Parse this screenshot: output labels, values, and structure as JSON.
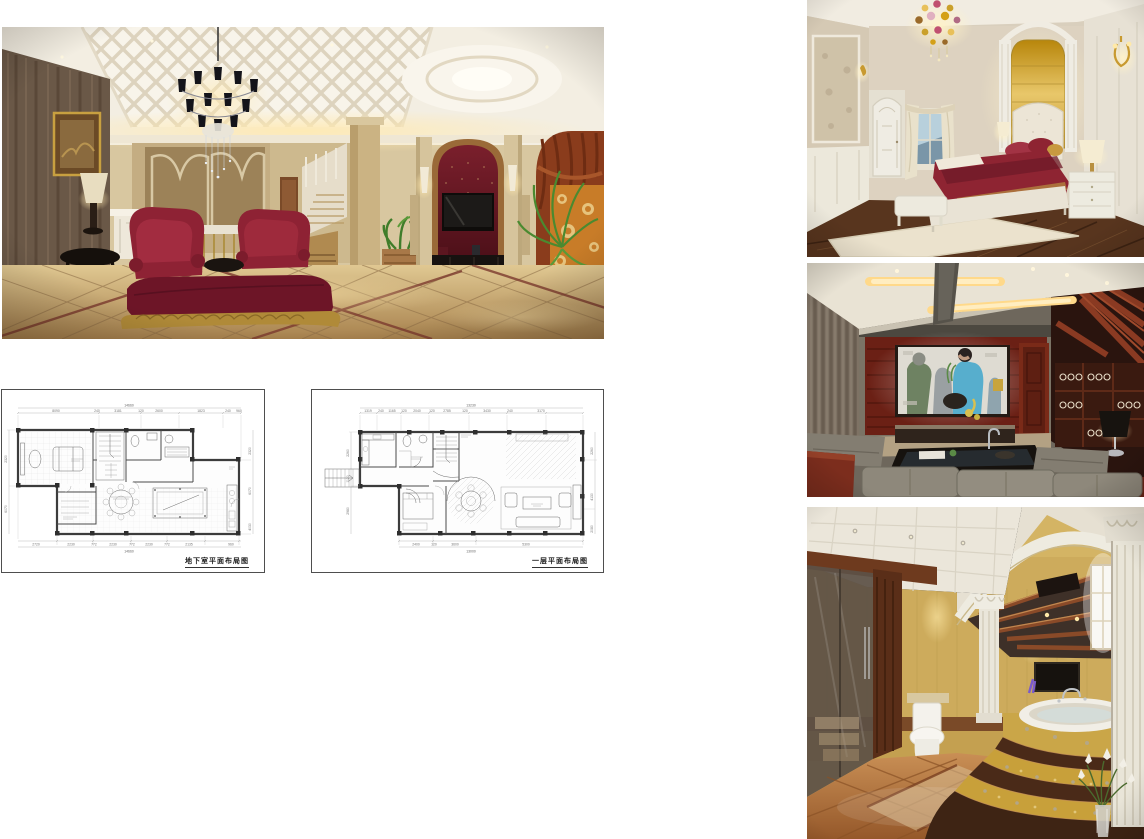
{
  "page": {
    "background": "#ffffff",
    "width": 1144,
    "height": 839,
    "description": "Interior design presentation board: four photorealistic renderings of a European-style villa (living room, bedroom, home theater, bathroom) and two CAD floor plan drawings"
  },
  "images": {
    "living_room": {
      "name": "European luxury living room rendering",
      "palette": {
        "ceiling": "#f3eee2",
        "wall": "#d8c7a0",
        "dark_marble_wall": "#6a5847",
        "tv_niche_red": "#5c161f",
        "sofa_red": "#8e2234",
        "chaise_red": "#6d1527",
        "curtain_orange": "#c87c28",
        "drape_rust": "#8a3c1c",
        "floor_marble": "#c7a468",
        "gold_trim": "#b08a38",
        "plant_green": "#4a8a30"
      }
    },
    "bedroom": {
      "name": "Master bedroom rendering",
      "palette": {
        "wall": "#d9cfbd",
        "gold_headboard_panel": "#d4a843",
        "bedding_red": "#8e2432",
        "wood_floor": "#58351e",
        "rug": "#ebe2cd",
        "trim_white": "#efece3"
      }
    },
    "home_theater": {
      "name": "Home theater / AV room rendering",
      "palette": {
        "ceiling": "#e9e3d4",
        "cove_light": "#ffd98a",
        "wall_gray": "#7b7365",
        "wood_red": "#6b2015",
        "screen": "#e8e6e0",
        "screen_blue": "#57aecd",
        "ottoman_gray": "#8d877b",
        "slat_wood": "#8a3a22"
      }
    },
    "bathroom": {
      "name": "Luxury bathroom rendering",
      "palette": {
        "wall_gold": "#d4b464",
        "floor_terracotta": "#b06f3e",
        "mosaic_gold": "#c8a03a",
        "marble_brown": "#4a2a18",
        "column_white": "#e9e5d8",
        "glass_shower": "#5d5146",
        "beam_wood": "#8a4a28"
      }
    }
  },
  "plans": [
    {
      "caption": "地下室平面布局图",
      "top_total": "14660",
      "bottom_total": "14660",
      "top_dims": [
        "8090",
        "240",
        "3181",
        "120",
        "2600",
        "1823",
        "240",
        "960"
      ],
      "bottom_dims": [
        "2720",
        "2230",
        "772",
        "2230",
        "772",
        "2230",
        "772",
        "2135",
        "960"
      ],
      "left_dims": [
        "2320",
        "6070"
      ],
      "right_dims": [
        "2320",
        "6070",
        "4030"
      ]
    },
    {
      "caption": "一层平面布局图",
      "top_total": "13230",
      "bottom_total": "13000",
      "top_dims": [
        "1319",
        "240",
        "1165",
        "120",
        "2040",
        "120",
        "2785",
        "120",
        "3430",
        "240",
        "3170"
      ],
      "bottom_dims": [
        "2400",
        "120",
        "3600",
        "5300"
      ],
      "left_dims": [
        "2260",
        "1120",
        "2980"
      ],
      "right_dims": [
        "2260",
        "4130",
        "2080"
      ]
    }
  ]
}
